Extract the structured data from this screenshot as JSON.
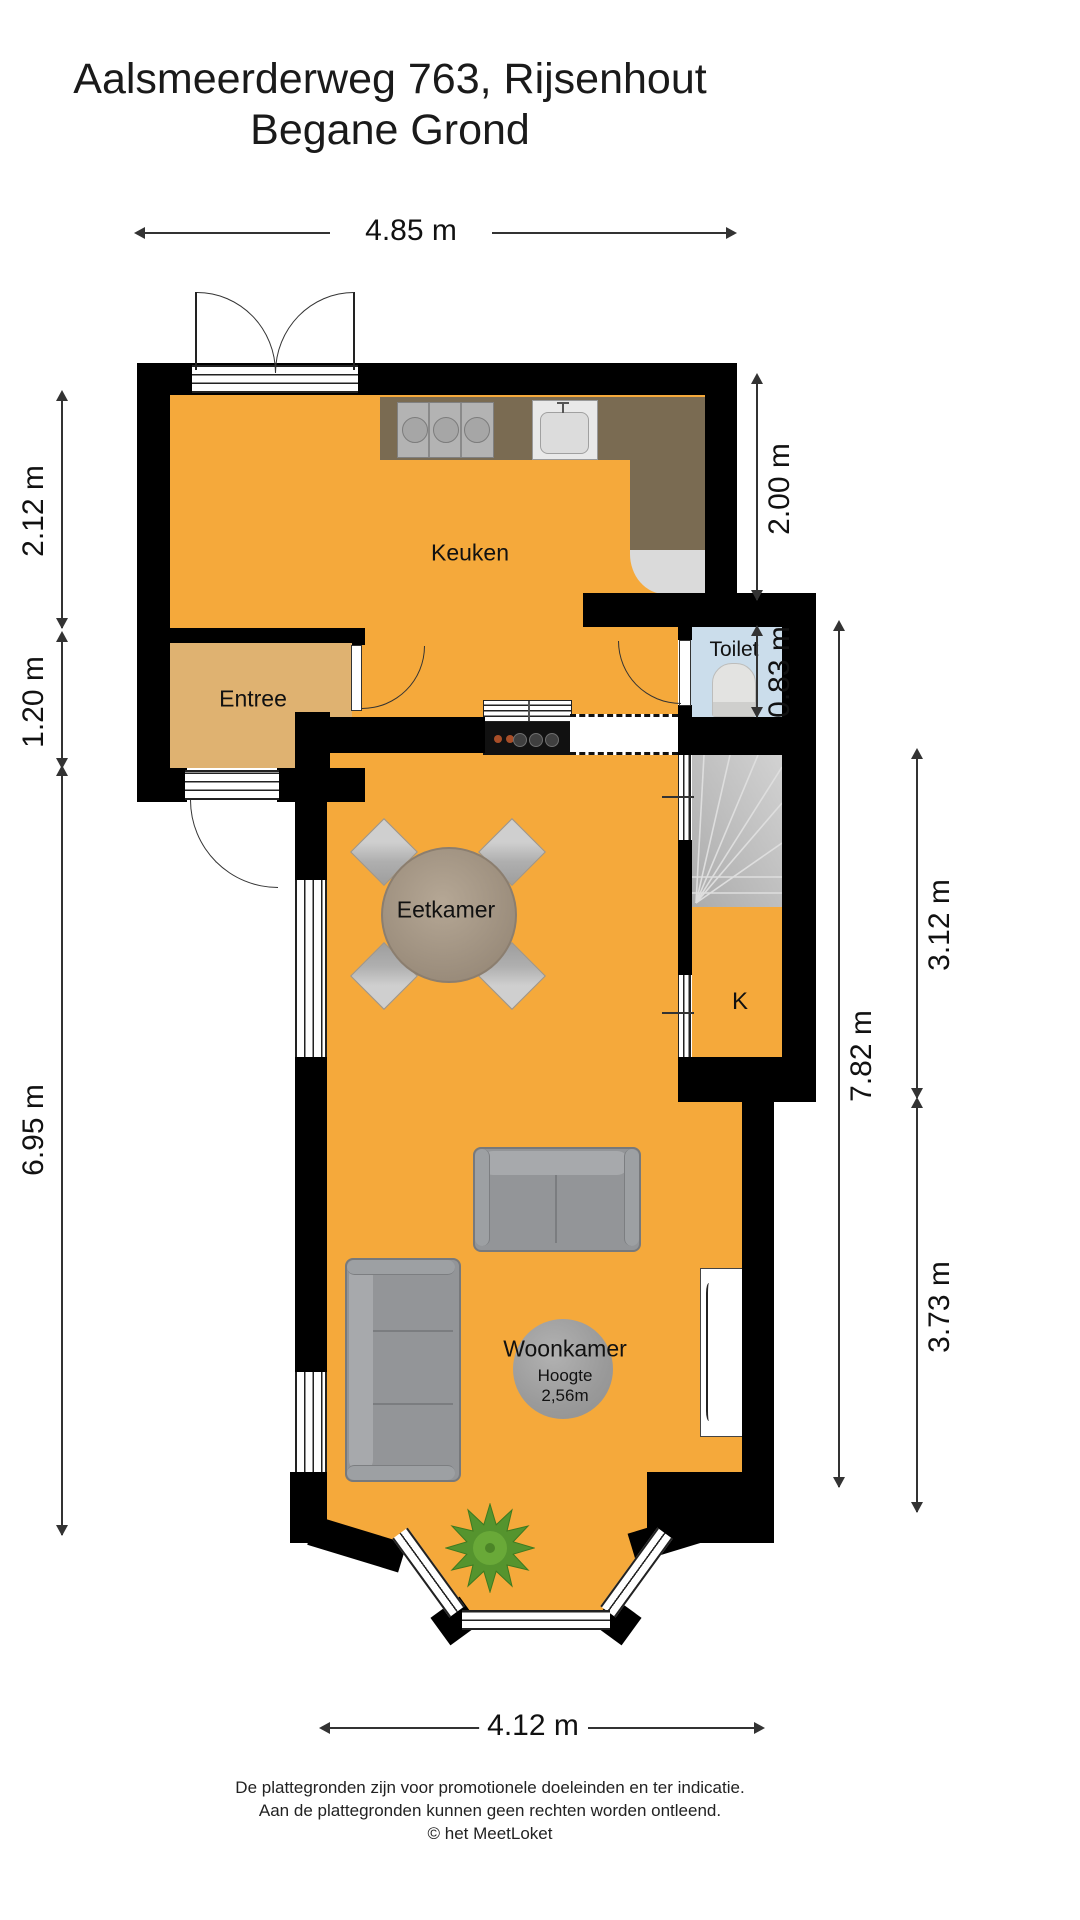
{
  "title": {
    "line1": "Aalsmeerderweg 763, Rijsenhout",
    "line2": "Begane Grond"
  },
  "rooms": {
    "kitchen": "Keuken",
    "entry": "Entree",
    "toilet": "Toilet",
    "dining": "Eetkamer",
    "closet": "K",
    "living": "Woonkamer"
  },
  "living_note": {
    "label": "Hoogte",
    "value": "2,56m"
  },
  "dimensions": {
    "top": "4.85 m",
    "bottom": "4.12 m",
    "left": [
      "2.12 m",
      "1.20 m",
      "6.95 m"
    ],
    "right": [
      "2.00 m",
      "0.83 m",
      "7.82 m",
      "3.12 m",
      "3.73 m"
    ]
  },
  "footer": {
    "line1": "De plattegronden zijn voor promotionele doeleinden en ter indicatie.",
    "line2": "Aan de plattegronden kunnen geen rechten worden ontleend.",
    "line3": "© het MeetLoket"
  },
  "colors": {
    "floor_main": "#F5A93B",
    "floor_entry": "#DFB271",
    "floor_toilet": "#CBDDEB",
    "stairs": "#B8B8B8",
    "counter": "#7A6B52",
    "wall": "#000000"
  }
}
